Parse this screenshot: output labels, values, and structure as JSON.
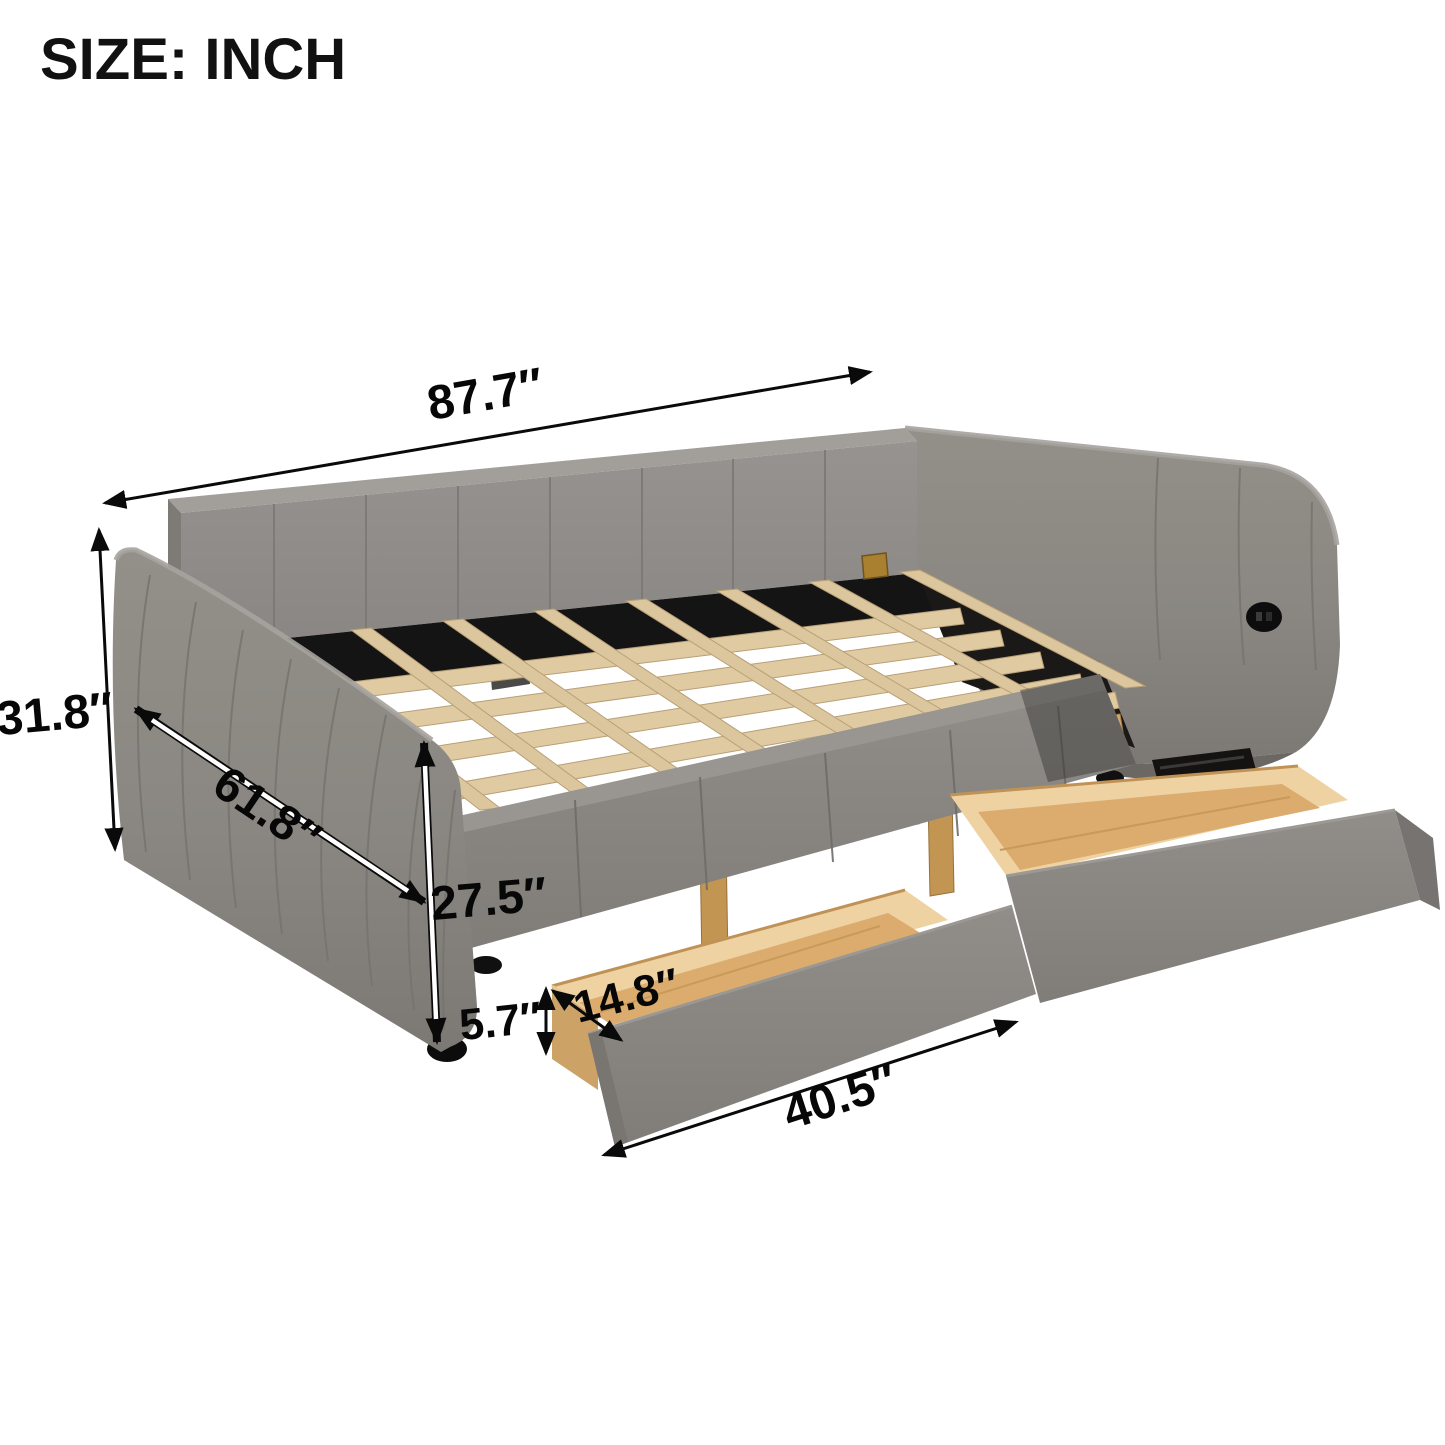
{
  "title": "SIZE: INCH",
  "dimensions": {
    "overall_width": "87.7″",
    "overall_height": "31.8″",
    "overall_depth": "61.8″",
    "platform_height": "27.5″",
    "drawer_height": "5.7″",
    "drawer_depth": "14.8″",
    "drawer_length": "40.5″"
  },
  "colors": {
    "background": "#ffffff",
    "upholstery": "#8c8985",
    "upholstery_dark": "#767370",
    "slat_wood": "#ddc79f",
    "drawer_wood": "#dcab6e",
    "metal_frame": "#141414",
    "annotation": "#0a0a0a"
  }
}
